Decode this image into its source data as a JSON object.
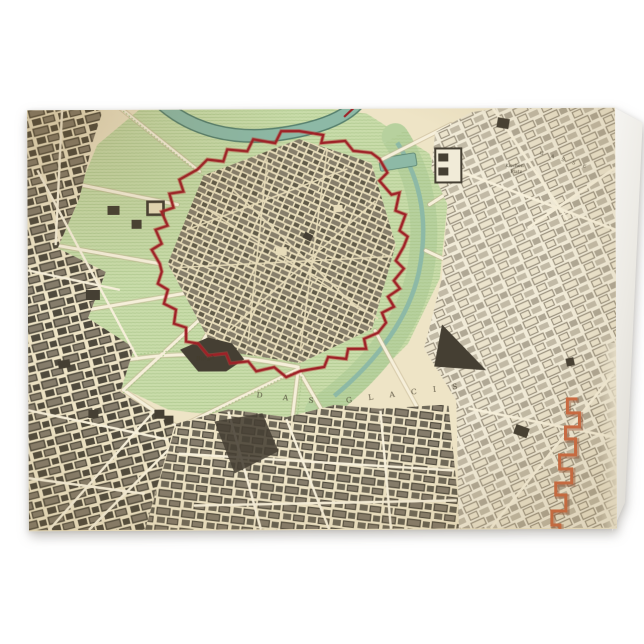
{
  "theme": {
    "bg": "#ffffff",
    "cardShadow": "rgba(70,62,50,0.28)",
    "paper": "#eee4c6",
    "paperOld": "#e7dcba",
    "paperRight": "#f1ebd8",
    "green": "#c9dcaa",
    "greenHatch": "#a6c286",
    "greenBand": "#b7d19e",
    "water": "#8db9a6",
    "waterEdge": "#57806e",
    "wall": "#9e2127",
    "wallGlow": "#b8433b",
    "bldTown": "#7e7664",
    "bldTownDark": "#55503f",
    "bldLeft": "#857c6b",
    "bldLeftDark": "#4f4a3d",
    "bldRight": "#9a917e",
    "bldRightFill": "#ebe3cc",
    "dark": "#453f33",
    "road": "#f6efda",
    "roadCase": "#c3b493",
    "linien": "#cd6a42",
    "linienDark": "#8a4a2e",
    "ink": "#443d2d",
    "backPanelLight": "#f6f5f2",
    "backPanelDark": "#d8d5ce"
  },
  "map": {
    "labels": {
      "burg": "Burgh",
      "das": "D A S",
      "glacis": "G L A C I S",
      "platz1": "Kirchen",
      "platz2": "Platz",
      "gasse": "G A S S E"
    }
  }
}
